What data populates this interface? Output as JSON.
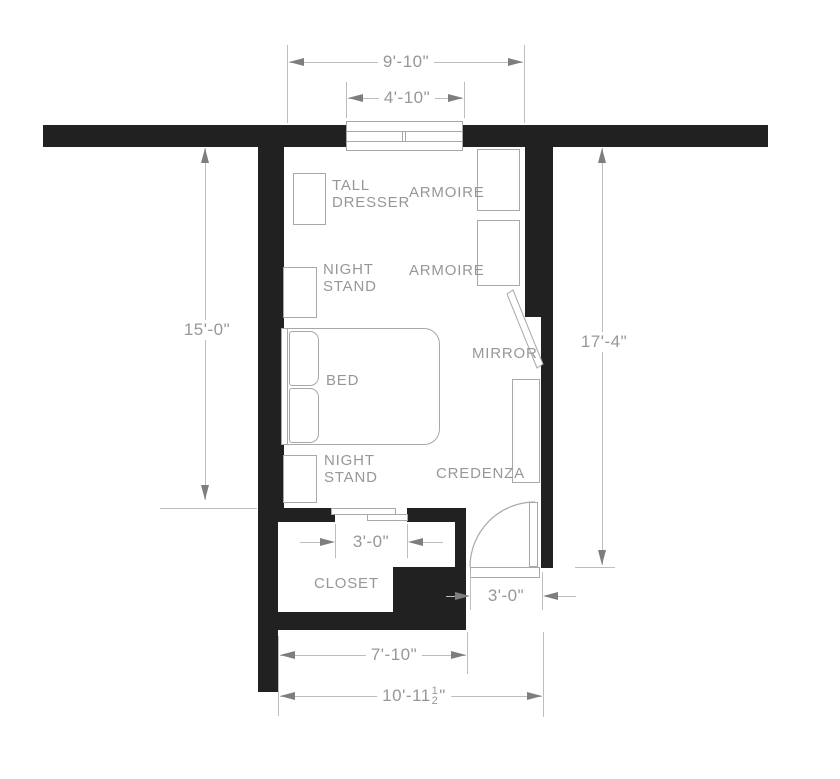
{
  "colors": {
    "wall": "#212121",
    "line": "#a8a8a8",
    "dim-line": "#bdbdbd",
    "arrow": "#7e7e7e",
    "text": "#979797",
    "bg": "#ffffff"
  },
  "labels": {
    "tall_dresser_1": "TALL",
    "tall_dresser_2": "DRESSER",
    "armoire_top": "ARMOIRE",
    "armoire_bottom": "ARMOIRE",
    "night_stand_top_1": "NIGHT",
    "night_stand_top_2": "STAND",
    "night_stand_bottom_1": "NIGHT",
    "night_stand_bottom_2": "STAND",
    "bed": "BED",
    "mirror": "MIRROR",
    "credenza": "CREDENZA",
    "closet": "CLOSET"
  },
  "dims": {
    "room_width": "9'-10\"",
    "window_width": "4'-10\"",
    "left_wall_height": "15'-0\"",
    "right_wall_height": "17'-4\"",
    "closet_opening": "3'-0\"",
    "entry_door": "3'-0\"",
    "closet_width": "7'-10\"",
    "overall_width_whole": "10'-11",
    "overall_width_frac_num": "1",
    "overall_width_frac_den": "2",
    "overall_width_unit": "\""
  }
}
